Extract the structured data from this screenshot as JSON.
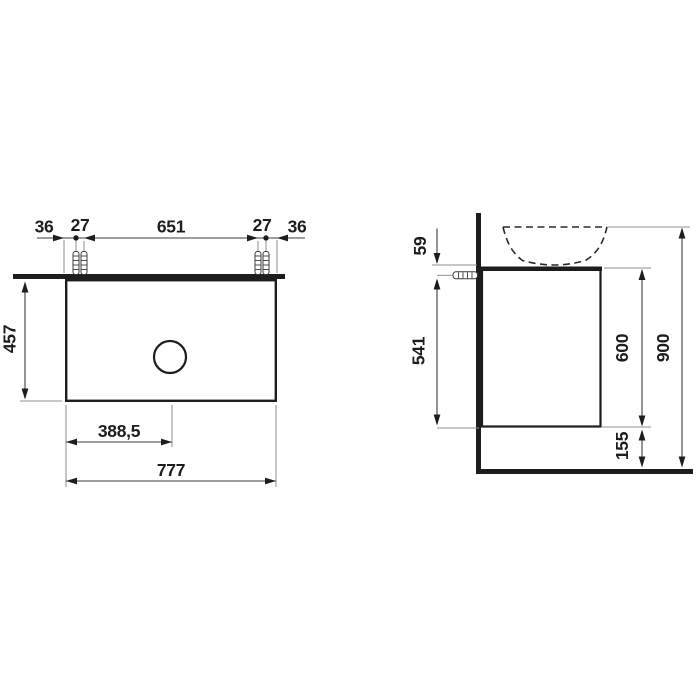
{
  "colors": {
    "ink": "#1d1d1b",
    "dimension_line": "#3c3c3c",
    "extension_line": "#8f8f8f",
    "background": "#ffffff"
  },
  "top_view": {
    "edge_to_hole_left": "36",
    "hole_pair_gap_left": "27",
    "holes_span": "651",
    "hole_pair_gap_right": "27",
    "edge_to_hole_right": "36",
    "depth": "457",
    "drain_offset": "388,5",
    "width": "777"
  },
  "side_view": {
    "basin_above_top": "59",
    "fixing_to_bottom": "541",
    "body_height": "600",
    "floor_clearance": "155",
    "total_height": "900"
  }
}
